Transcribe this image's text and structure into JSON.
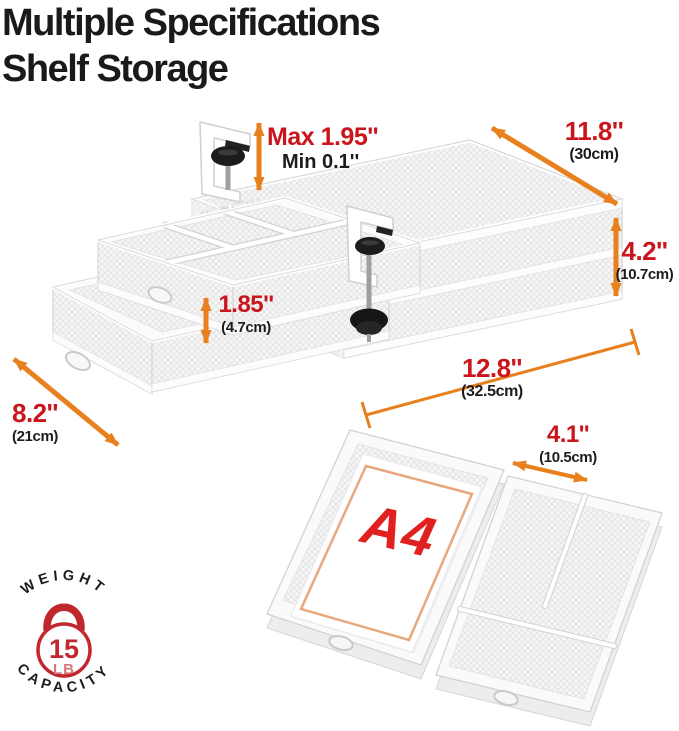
{
  "title": {
    "line1": "Multiple Specifications",
    "line2": "Shelf Storage"
  },
  "dims": {
    "clamp_max": "Max 1.95''",
    "clamp_min": "Min 0.1''",
    "depth": {
      "inch": "11.8''",
      "cm": "(30cm)"
    },
    "height": {
      "inch": "4.2''",
      "cm": "(10.7cm)"
    },
    "drawer_height": {
      "inch": "1.85''",
      "cm": "(4.7cm)"
    },
    "width": {
      "inch": "12.8''",
      "cm": "(32.5cm)"
    },
    "side": {
      "inch": "8.2''",
      "cm": "(21cm)"
    },
    "compartment": {
      "inch": "4.1''",
      "cm": "(10.5cm)"
    }
  },
  "paper": {
    "label": "A4"
  },
  "badge": {
    "top": "WEIGHT",
    "bottom": "CAPACITY",
    "value": "15",
    "unit": "LB"
  },
  "colors": {
    "dimension_red": "#c9151b",
    "text_black": "#1c1c1c",
    "arrow_orange": "#e8801e",
    "badge_red": "#c2272d",
    "a4_red": "#e0211f",
    "paper_border_orange": "#e7a87d"
  }
}
